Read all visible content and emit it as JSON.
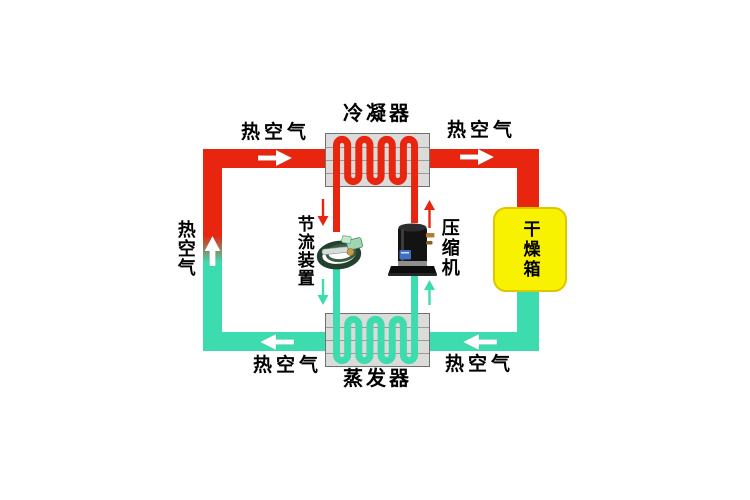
{
  "diagram": {
    "type": "heat-pump-dryer-schematic",
    "components": {
      "condenser_label": "冷凝器",
      "evaporator_label": "蒸发器",
      "throttle_label": "节流装置",
      "compressor_label": "压缩机",
      "dryer_label": "干燥箱"
    },
    "flow_labels": {
      "hot_air_top_left": "热空气",
      "hot_air_top_right": "热空气",
      "hot_air_left": "热空气",
      "hot_air_bottom_left": "热空气",
      "hot_air_bottom_right": "热空气"
    },
    "colors": {
      "hot_pipe": "#e8250e",
      "cold_pipe": "#3cdcae",
      "dryer_box": "#f8f200",
      "dryer_box_border": "#ddc702",
      "exchanger_fill": "#dbdbd9",
      "exchanger_border": "#707070",
      "fin_line": "#9a9a98",
      "background": "#ffffff",
      "text": "#000000"
    }
  }
}
